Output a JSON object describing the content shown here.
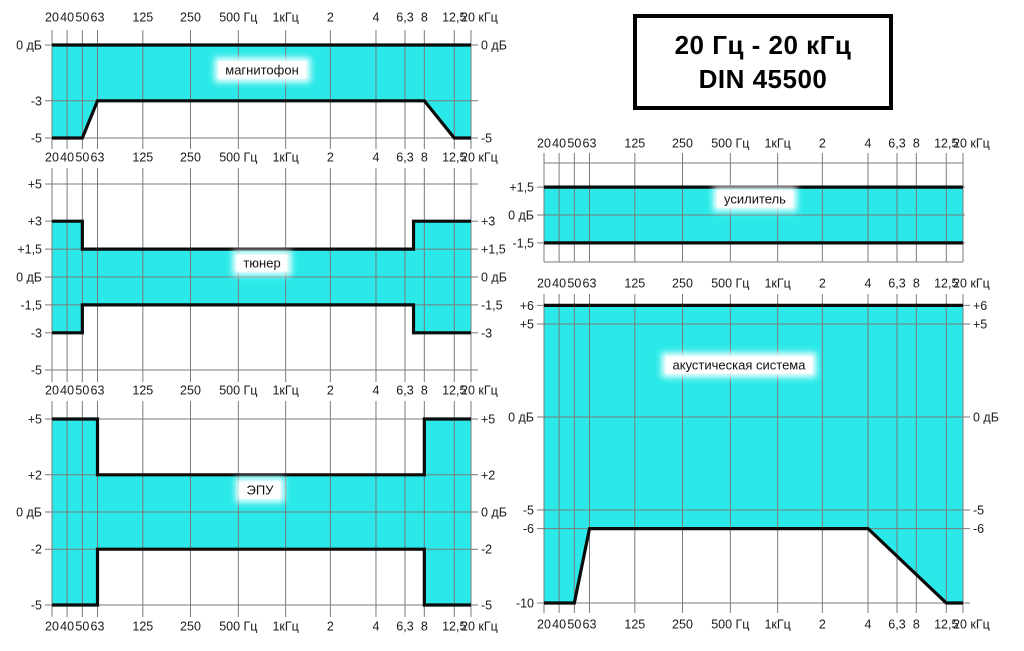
{
  "title_box": {
    "line1": "20 Гц - 20 кГц",
    "line2": "DIN 45500"
  },
  "colors": {
    "band_fill": "#2be9e9",
    "band_outline": "#0b0b0b",
    "grid_line": "#7a7a7a",
    "text": "#1a1a1a",
    "background": "#ffffff"
  },
  "freq_axis": {
    "tick_labels": [
      "20",
      "40",
      "50",
      "63",
      "125",
      "250",
      "500 Гц",
      "1кГц",
      "2",
      "4",
      "6,3",
      "8",
      "12,5",
      "20 кГц"
    ],
    "tick_freqs_hz": [
      20,
      40,
      50,
      63,
      125,
      250,
      500,
      1000,
      2000,
      4000,
      6300,
      8000,
      12500,
      20000
    ],
    "tick_fractions": [
      0,
      0.036,
      0.0724,
      0.1086,
      0.2168,
      0.3305,
      0.4447,
      0.5577,
      0.6643,
      0.7732,
      0.8425,
      0.8886,
      0.9601,
      1
    ]
  },
  "chart_data": [
    {
      "type": "area",
      "id": "magnitofon",
      "label": "магнитофон",
      "ylabel": "дБ",
      "xlim_hz": [
        20,
        20000
      ],
      "upper_limit_db": [
        [
          20,
          0
        ],
        [
          20000,
          0
        ]
      ],
      "lower_limit_db": [
        [
          20,
          -5
        ],
        [
          50,
          -5
        ],
        [
          63,
          -3
        ],
        [
          8000,
          -3
        ],
        [
          12500,
          -5
        ],
        [
          20000,
          -5
        ]
      ],
      "left_axis_labels": [
        {
          "db": 0,
          "text": "0 дБ"
        },
        {
          "db": -3,
          "text": "-3"
        },
        {
          "db": -5,
          "text": "-5"
        }
      ],
      "right_axis_labels": [
        {
          "db": 0,
          "text": "0 дБ"
        },
        {
          "db": -5,
          "text": "-5"
        }
      ],
      "gridlines_db": [
        0,
        -3,
        -5
      ],
      "layout": {
        "col": "left",
        "y_zero": 45,
        "grid_top": 30,
        "grid_bottom": 149,
        "label_cx": 262,
        "label_cy": 70
      }
    },
    {
      "type": "area",
      "id": "tyuner",
      "label": "тюнер",
      "ylabel": "дБ",
      "xlim_hz": [
        20,
        20000
      ],
      "upper_limit_db": [
        [
          20,
          3
        ],
        [
          50,
          3
        ],
        [
          50,
          1.5
        ],
        [
          7000,
          1.5
        ],
        [
          7000,
          3
        ],
        [
          20000,
          3
        ]
      ],
      "lower_limit_db": [
        [
          20,
          -3
        ],
        [
          50,
          -3
        ],
        [
          50,
          -1.5
        ],
        [
          7000,
          -1.5
        ],
        [
          7000,
          -3
        ],
        [
          20000,
          -3
        ]
      ],
      "left_axis_labels": [
        {
          "db": 5,
          "text": "+5"
        },
        {
          "db": 3,
          "text": "+3"
        },
        {
          "db": 1.5,
          "text": "+1,5"
        },
        {
          "db": 0,
          "text": "0 дБ"
        },
        {
          "db": -1.5,
          "text": "-1,5"
        },
        {
          "db": -3,
          "text": "-3"
        },
        {
          "db": -5,
          "text": "-5"
        }
      ],
      "right_axis_labels": [
        {
          "db": 3,
          "text": "+3"
        },
        {
          "db": 1.5,
          "text": "+1,5"
        },
        {
          "db": 0,
          "text": "0 дБ"
        },
        {
          "db": -1.5,
          "text": "-1,5"
        },
        {
          "db": -3,
          "text": "-3"
        }
      ],
      "gridlines_db": [
        5,
        1.5,
        0,
        -1.5,
        -5
      ],
      "layout": {
        "col": "left",
        "y_zero": 277,
        "grid_top": 168,
        "grid_bottom": 382,
        "label_cx": 262,
        "label_cy": 263
      }
    },
    {
      "type": "area",
      "id": "epu",
      "label": "ЭПУ",
      "ylabel": "дБ",
      "xlim_hz": [
        20,
        20000
      ],
      "upper_limit_db": [
        [
          20,
          5
        ],
        [
          63,
          5
        ],
        [
          63,
          2
        ],
        [
          8000,
          2
        ],
        [
          8000,
          5
        ],
        [
          20000,
          5
        ]
      ],
      "lower_limit_db": [
        [
          20,
          -5
        ],
        [
          63,
          -5
        ],
        [
          63,
          -2
        ],
        [
          8000,
          -2
        ],
        [
          8000,
          -5
        ],
        [
          20000,
          -5
        ]
      ],
      "left_axis_labels": [
        {
          "db": 5,
          "text": "+5"
        },
        {
          "db": 2,
          "text": "+2"
        },
        {
          "db": 0,
          "text": "0 дБ"
        },
        {
          "db": -2,
          "text": "-2"
        },
        {
          "db": -5,
          "text": "-5"
        }
      ],
      "right_axis_labels": [
        {
          "db": 5,
          "text": "+5"
        },
        {
          "db": 2,
          "text": "+2"
        },
        {
          "db": 0,
          "text": "0 дБ"
        },
        {
          "db": -2,
          "text": "-2"
        },
        {
          "db": -5,
          "text": "-5"
        }
      ],
      "gridlines_db": [
        5,
        2,
        0,
        -2,
        -5
      ],
      "layout": {
        "col": "left",
        "y_zero": 512,
        "grid_top": 401,
        "grid_bottom": 617,
        "label_cx": 260,
        "label_cy": 490
      }
    },
    {
      "type": "area",
      "id": "usilitel",
      "label": "усилитель",
      "ylabel": "дБ",
      "xlim_hz": [
        20,
        20000
      ],
      "upper_limit_db": [
        [
          20,
          1.5
        ],
        [
          20000,
          1.5
        ]
      ],
      "lower_limit_db": [
        [
          20,
          -1.5
        ],
        [
          20000,
          -1.5
        ]
      ],
      "left_axis_labels": [
        {
          "db": 1.5,
          "text": "+1,5"
        },
        {
          "db": 0,
          "text": "0 дБ"
        },
        {
          "db": -1.5,
          "text": "-1,5"
        }
      ],
      "right_axis_labels": [],
      "gridlines_db": [
        1.5,
        0,
        -1.5
      ],
      "layout": {
        "col": "right",
        "y_zero": 215,
        "grid_top": 153,
        "grid_bottom": 262,
        "label_cx": 755,
        "label_cy": 199,
        "extra_grid_y": [
          163,
          262
        ]
      }
    },
    {
      "type": "area",
      "id": "akustika",
      "label": "акустическая система",
      "ylabel": "дБ",
      "xlim_hz": [
        20,
        20000
      ],
      "upper_limit_db": [
        [
          20,
          6
        ],
        [
          20000,
          6
        ]
      ],
      "lower_limit_db": [
        [
          20,
          -10
        ],
        [
          50,
          -10
        ],
        [
          63,
          -6
        ],
        [
          4000,
          -6
        ],
        [
          12500,
          -10
        ],
        [
          20000,
          -10
        ]
      ],
      "left_axis_labels": [
        {
          "db": 6,
          "text": "+6"
        },
        {
          "db": 5,
          "text": "+5"
        },
        {
          "db": 0,
          "text": "0 дБ"
        },
        {
          "db": -5,
          "text": "-5"
        },
        {
          "db": -6,
          "text": "-6"
        },
        {
          "db": -10,
          "text": "-10"
        }
      ],
      "right_axis_labels": [
        {
          "db": 6,
          "text": "+6"
        },
        {
          "db": 5,
          "text": "+5"
        },
        {
          "db": 0,
          "text": "0 дБ"
        },
        {
          "db": -5,
          "text": "-5"
        },
        {
          "db": -6,
          "text": "-6"
        }
      ],
      "gridlines_db": [
        6,
        5,
        0,
        -5,
        -6,
        -10
      ],
      "layout": {
        "col": "right",
        "y_zero": 417,
        "grid_top": 294,
        "grid_bottom": 613,
        "label_cx": 739,
        "label_cy": 365
      }
    }
  ],
  "layout": {
    "px_per_db": 18.6,
    "columns": {
      "left": {
        "plot_left": 52,
        "plot_width": 419
      },
      "right": {
        "plot_left": 544,
        "plot_width": 419
      }
    },
    "freq_label_rows": {
      "left": [
        17,
        157,
        390,
        626
      ],
      "right": [
        143,
        283,
        624
      ]
    }
  }
}
